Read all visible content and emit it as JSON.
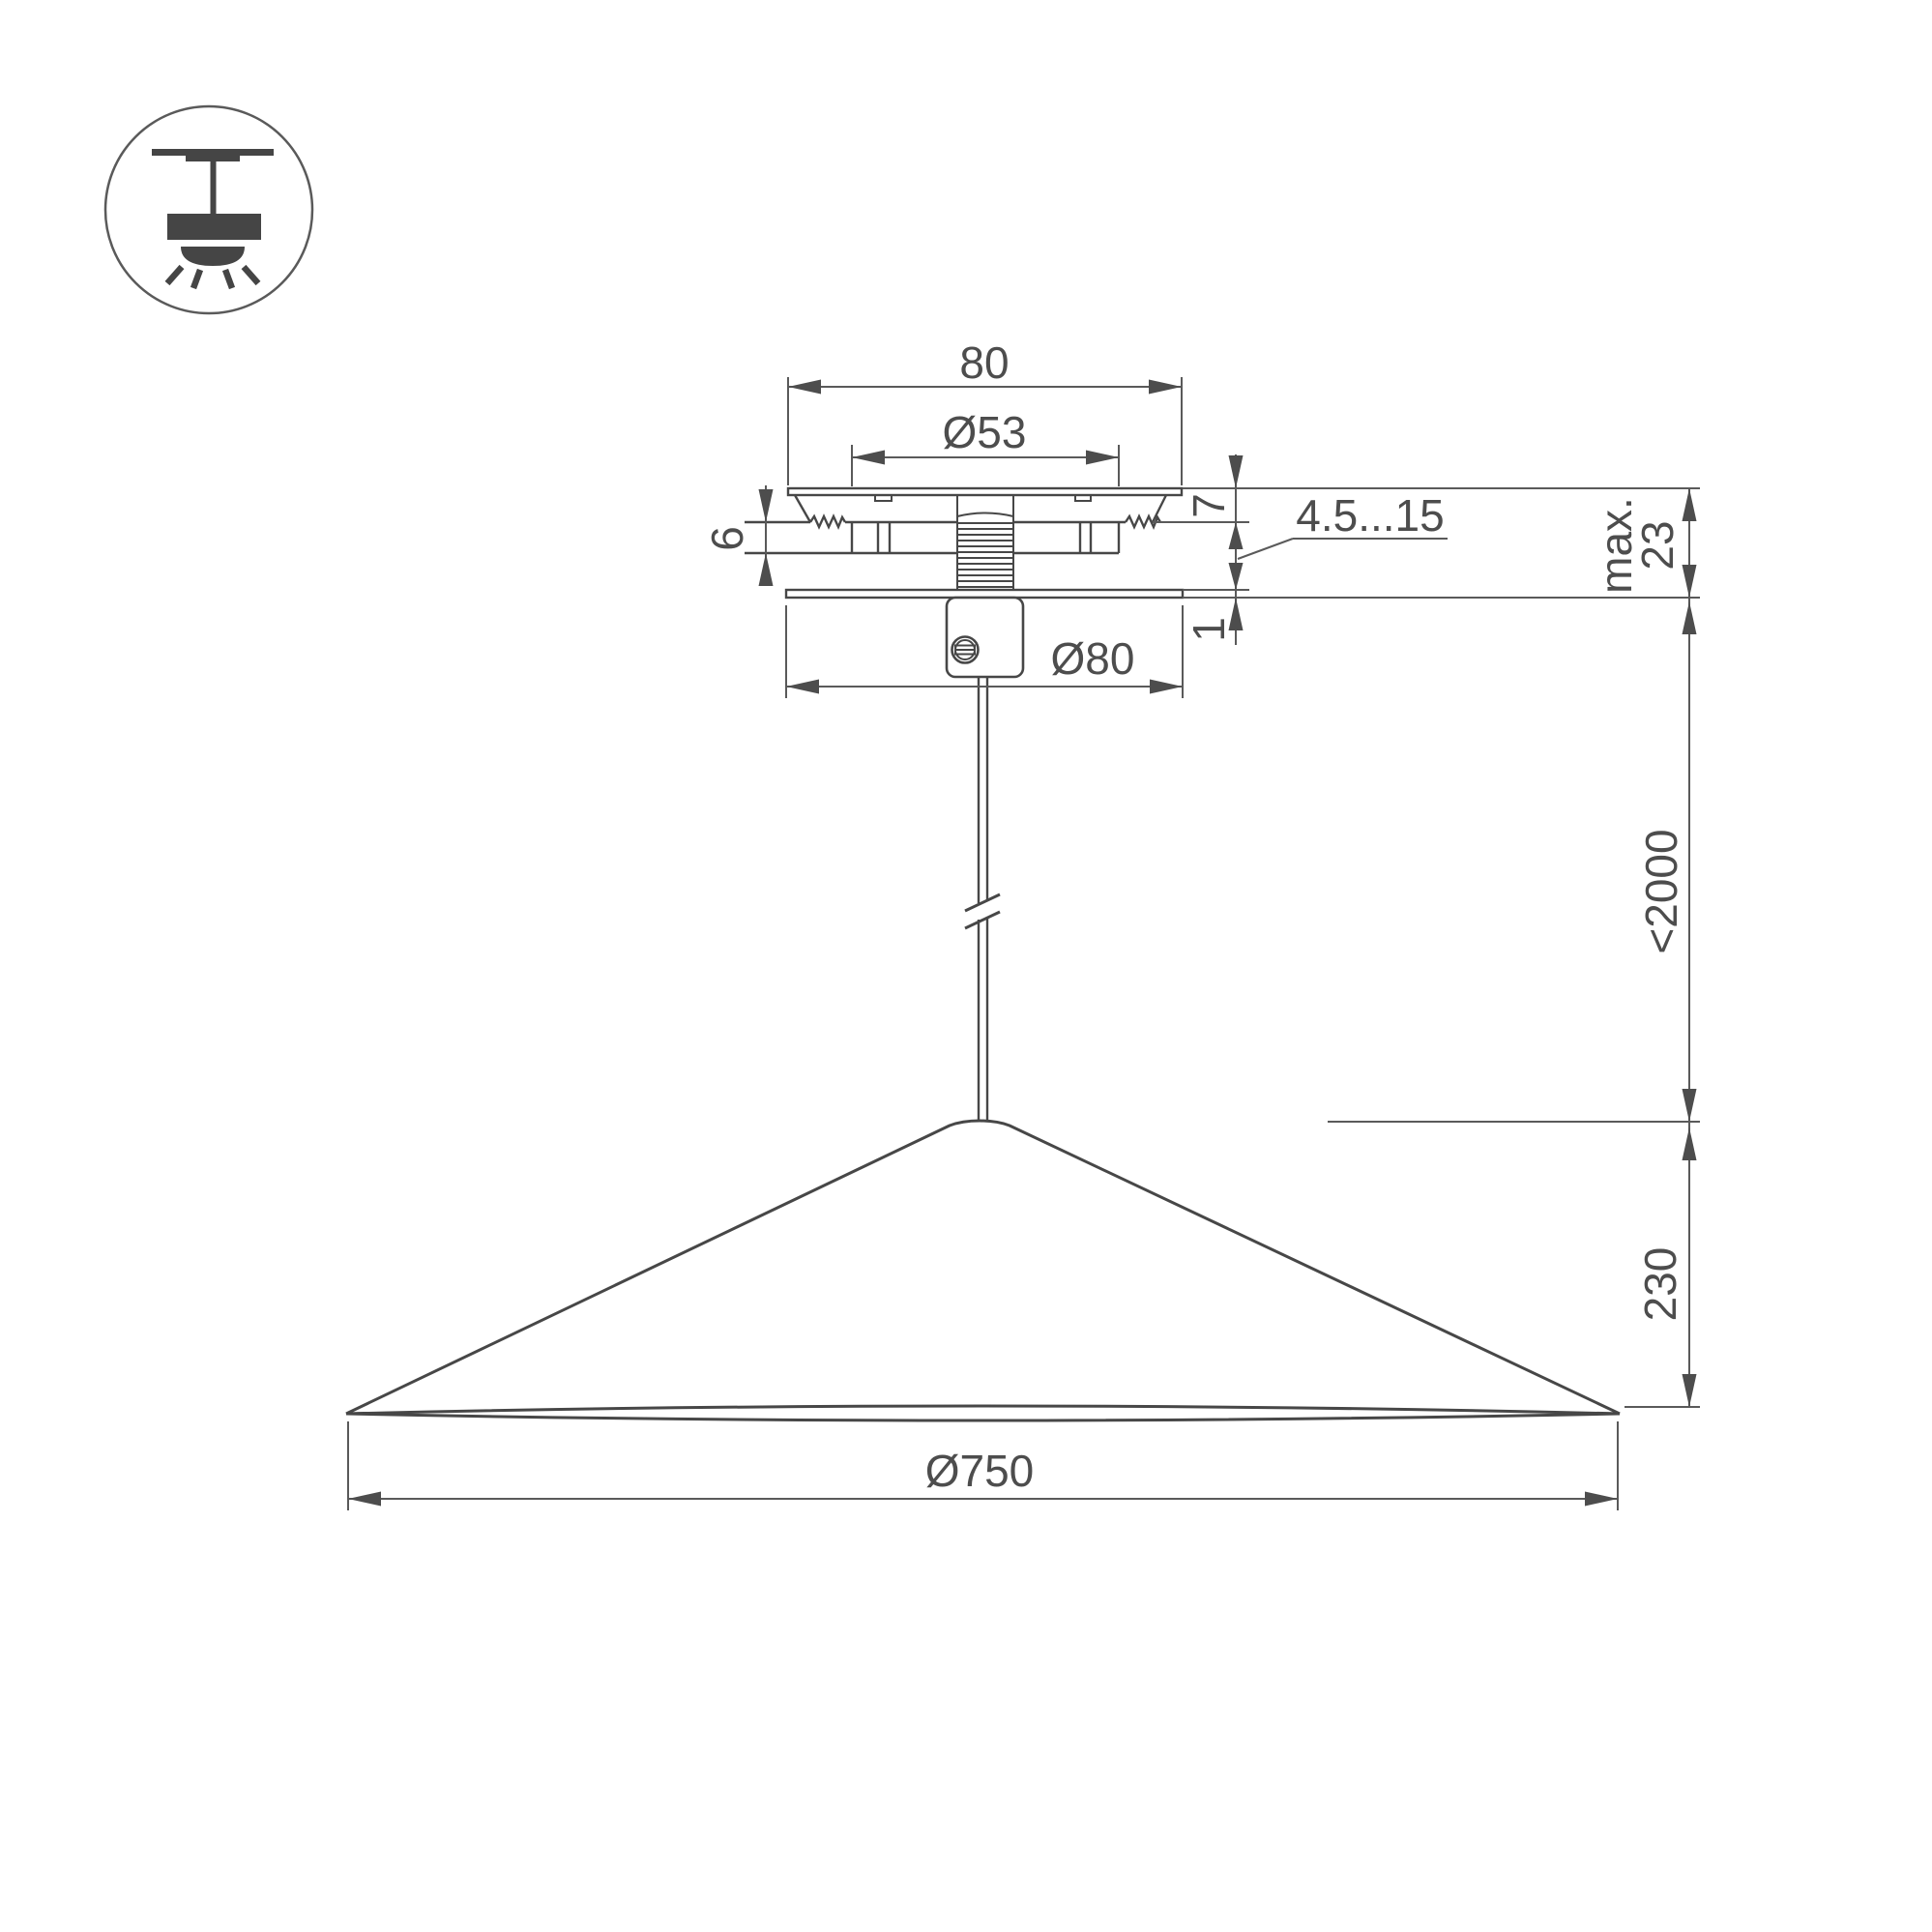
{
  "page": {
    "background": "#ffffff",
    "type": "technical-dimension-drawing"
  },
  "colors": {
    "line": "#474747",
    "dimension": "#5a5a5a",
    "text": "#4d4d4d"
  },
  "icon": {
    "name": "ceiling-pendant-light-icon"
  },
  "dims": {
    "canopy_width": "80",
    "hole_diameter": "Ø53",
    "upper_gap": "7",
    "bracket_height": "6",
    "clamp_range": "4.5...15",
    "max_label": "max.",
    "max_value": "23",
    "plate_thickness": "1",
    "plate_diameter": "Ø80",
    "cable_length": "<2000",
    "shade_height": "230",
    "shade_diameter": "Ø750"
  }
}
